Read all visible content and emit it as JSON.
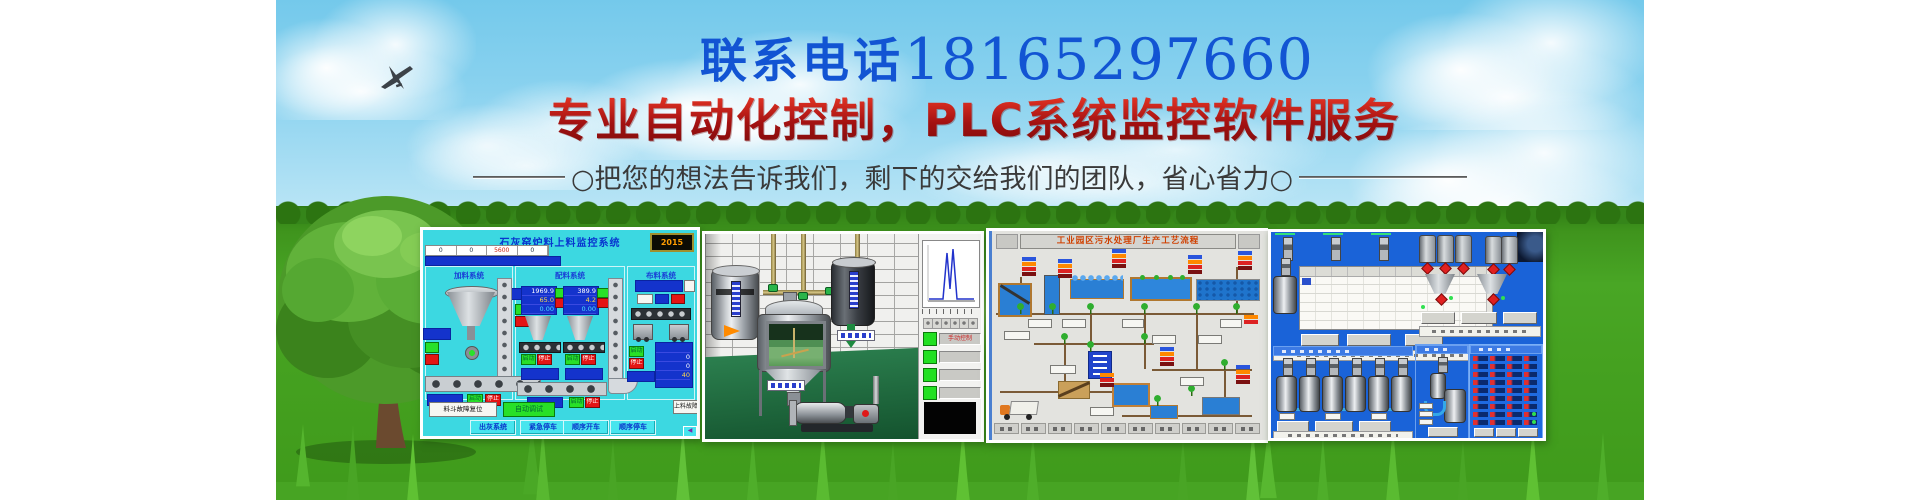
{
  "banner": {
    "phone_prefix": "联系电话",
    "phone_number": "18165297660",
    "headline": "专业自动化控制，PLC系统监控软件服务",
    "tagline": "○把您的想法告诉我们，剩下的交给我们的团队，省心省力○"
  },
  "colors": {
    "phone_blue": "#1254d3",
    "headline_red_top": "#e23324",
    "headline_red_bottom": "#7c0b0b",
    "sky_top": "#74c9eb",
    "grass_green": "#3f9a1b",
    "panel1_bg": "#3cd8e1",
    "panel3_title_red": "#d04000",
    "panel4_bg": "#1a63d8"
  },
  "panel1": {
    "title": "石灰窑炉料上料监控系统",
    "clock": "2015",
    "cells": [
      "0",
      "0",
      "5600",
      "0"
    ],
    "sections": {
      "feed": "加料系统",
      "batch": "配料系统",
      "dist": "布料系统"
    },
    "hopper1": [
      "1969.9",
      "65.0",
      "0.00"
    ],
    "hopper2": [
      "389.9",
      "4.2",
      "0.00"
    ],
    "right_values": [
      "0",
      "0",
      "40"
    ],
    "start": "启动",
    "stop": "停止",
    "reset_button": "料斗故障复位",
    "auto_button": "自动调试",
    "right_button": "上料故障",
    "bottom_buttons": [
      "出灰系统",
      "紧急停车",
      "顺序开车",
      "顺序停车"
    ]
  },
  "panel2": {
    "manual_label": "手动控制"
  },
  "panel3": {
    "title": "工业园区污水处理厂生产工艺流程"
  }
}
